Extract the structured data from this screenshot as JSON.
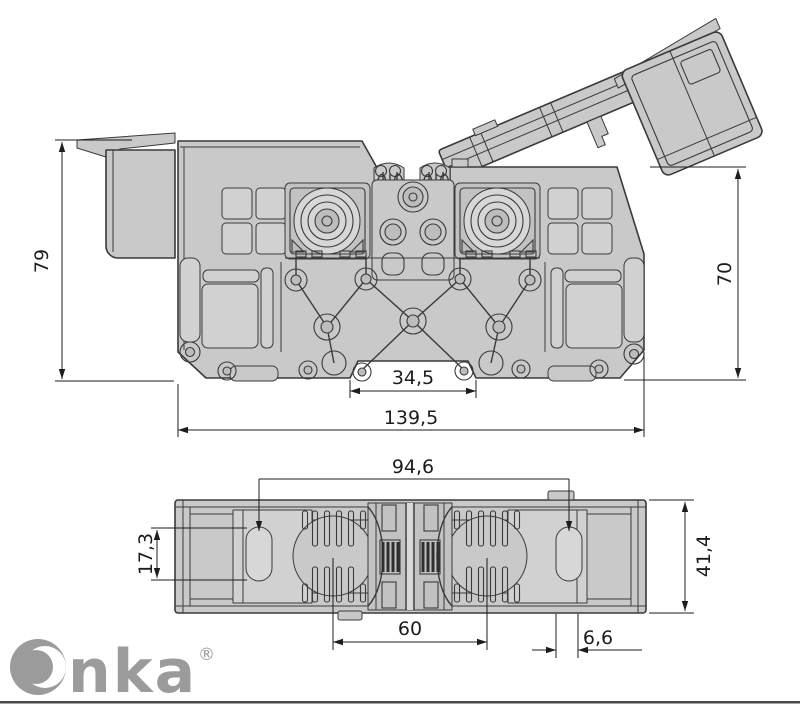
{
  "colors": {
    "background": "#ffffff",
    "body_fill": "#c9c9c9",
    "panel_fill": "#d1d1d1",
    "outline": "#3a3a3a",
    "dimension": "#1c1c1c",
    "logo_gray": "#9b9b9b",
    "footer_rule": "#4a4a4a"
  },
  "side_view": {
    "dim_overall_height": "79",
    "dim_body_height": "70",
    "dim_rail_notch_width": "34,5",
    "dim_overall_width": "139,5"
  },
  "bottom_view": {
    "dim_socket_span": "94,6",
    "dim_slot_height": "17,3",
    "dim_overall_depth": "41,4",
    "dim_module_span": "60",
    "dim_slot_width": "6,6"
  },
  "brand": {
    "name": "Onka",
    "wordmark_tail": "nka",
    "registered_mark": "®"
  }
}
